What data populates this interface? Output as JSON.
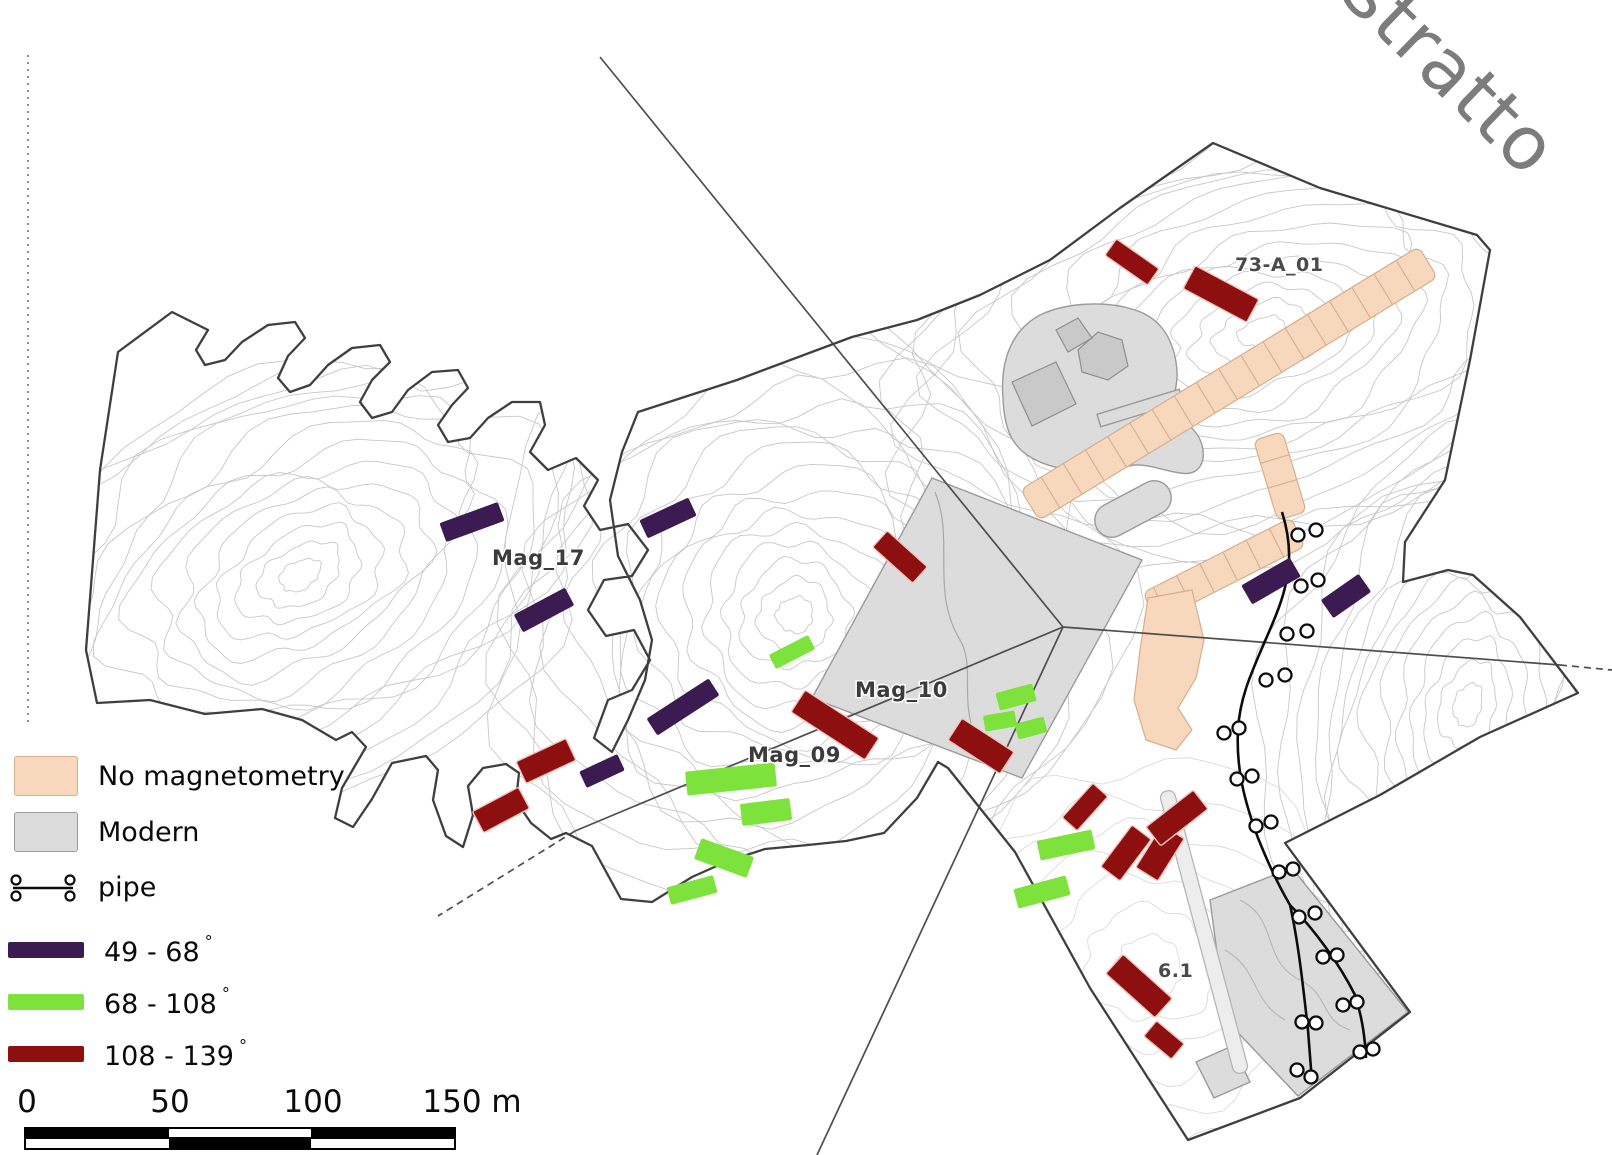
{
  "watermark": {
    "text": "Estratto"
  },
  "legend": {
    "items": [
      {
        "id": "no-magnetometry",
        "label": "No magnetometry",
        "swatch": "peach"
      },
      {
        "id": "modern",
        "label": "Modern",
        "swatch": "gray"
      },
      {
        "id": "pipe",
        "label": "pipe",
        "swatch": "pipe"
      },
      {
        "id": "angle-49-68",
        "label": "49 - 68",
        "degree": "°",
        "swatch": "purple"
      },
      {
        "id": "angle-68-108",
        "label": "68 - 108",
        "degree": "°",
        "swatch": "green"
      },
      {
        "id": "angle-108-139",
        "label": "108 - 139",
        "degree": "°",
        "swatch": "red"
      }
    ]
  },
  "scale_bar": {
    "ticks": [
      "0",
      "50",
      "100",
      "150 m"
    ]
  },
  "map": {
    "labels": [
      {
        "text": "Mag_17",
        "x": 492,
        "y": 565,
        "size": "normal"
      },
      {
        "text": "Mag_10",
        "x": 855,
        "y": 697,
        "size": "normal"
      },
      {
        "text": "Mag_09",
        "x": 748,
        "y": 762,
        "size": "normal"
      },
      {
        "text": "73-A_01",
        "x": 1235,
        "y": 271,
        "size": "small"
      },
      {
        "text": "6.1",
        "x": 1158,
        "y": 977,
        "size": "small"
      }
    ],
    "bars": [
      {
        "type": "p",
        "cx": 472,
        "cy": 522,
        "len": 62,
        "th": 20,
        "angle": -20
      },
      {
        "type": "p",
        "cx": 668,
        "cy": 518,
        "len": 54,
        "th": 20,
        "angle": -25
      },
      {
        "type": "p",
        "cx": 544,
        "cy": 610,
        "len": 58,
        "th": 20,
        "angle": -28
      },
      {
        "type": "p",
        "cx": 683,
        "cy": 707,
        "len": 74,
        "th": 20,
        "angle": -33
      },
      {
        "type": "p",
        "cx": 602,
        "cy": 771,
        "len": 42,
        "th": 18,
        "angle": -25
      },
      {
        "type": "p",
        "cx": 1271,
        "cy": 581,
        "len": 56,
        "th": 22,
        "angle": -30
      },
      {
        "type": "p",
        "cx": 1346,
        "cy": 596,
        "len": 46,
        "th": 22,
        "angle": -35
      },
      {
        "type": "g",
        "cx": 792,
        "cy": 652,
        "len": 44,
        "th": 16,
        "angle": -27
      },
      {
        "type": "g",
        "cx": 731,
        "cy": 779,
        "len": 90,
        "th": 24,
        "angle": -6
      },
      {
        "type": "g",
        "cx": 766,
        "cy": 812,
        "len": 50,
        "th": 22,
        "angle": -7
      },
      {
        "type": "g",
        "cx": 724,
        "cy": 858,
        "len": 56,
        "th": 22,
        "angle": 20
      },
      {
        "type": "g",
        "cx": 692,
        "cy": 890,
        "len": 48,
        "th": 18,
        "angle": -15
      },
      {
        "type": "g",
        "cx": 1066,
        "cy": 845,
        "len": 56,
        "th": 20,
        "angle": -12
      },
      {
        "type": "g",
        "cx": 1042,
        "cy": 892,
        "len": 54,
        "th": 20,
        "angle": -15
      },
      {
        "type": "g",
        "cx": 1016,
        "cy": 697,
        "len": 38,
        "th": 18,
        "angle": -15
      },
      {
        "type": "g",
        "cx": 1000,
        "cy": 721,
        "len": 32,
        "th": 16,
        "angle": -10
      },
      {
        "type": "g",
        "cx": 1031,
        "cy": 728,
        "len": 30,
        "th": 16,
        "angle": -15
      },
      {
        "type": "r",
        "cx": 1132,
        "cy": 262,
        "len": 52,
        "th": 20,
        "angle": 35
      },
      {
        "type": "r",
        "cx": 1221,
        "cy": 294,
        "len": 72,
        "th": 26,
        "angle": 28
      },
      {
        "type": "r",
        "cx": 900,
        "cy": 557,
        "len": 54,
        "th": 22,
        "angle": 42
      },
      {
        "type": "r",
        "cx": 835,
        "cy": 725,
        "len": 88,
        "th": 26,
        "angle": 33
      },
      {
        "type": "r",
        "cx": 981,
        "cy": 746,
        "len": 62,
        "th": 26,
        "angle": 33
      },
      {
        "type": "r",
        "cx": 1085,
        "cy": 807,
        "len": 46,
        "th": 20,
        "angle": -48
      },
      {
        "type": "r",
        "cx": 1126,
        "cy": 853,
        "len": 52,
        "th": 24,
        "angle": -53
      },
      {
        "type": "r",
        "cx": 1160,
        "cy": 853,
        "len": 50,
        "th": 26,
        "angle": -58
      },
      {
        "type": "r",
        "cx": 1177,
        "cy": 818,
        "len": 60,
        "th": 24,
        "angle": -38
      },
      {
        "type": "r",
        "cx": 546,
        "cy": 761,
        "len": 55,
        "th": 24,
        "angle": -25
      },
      {
        "type": "r",
        "cx": 501,
        "cy": 810,
        "len": 52,
        "th": 24,
        "angle": -28
      },
      {
        "type": "r",
        "cx": 1139,
        "cy": 986,
        "len": 66,
        "th": 26,
        "angle": 42
      },
      {
        "type": "r",
        "cx": 1164,
        "cy": 1040,
        "len": 36,
        "th": 20,
        "angle": 40
      }
    ]
  },
  "colors": {
    "peach": "#f7d8bd",
    "peach-stroke": "#d5ae8e",
    "modern": "#dcdcdc",
    "modern-stroke": "#9a9a9a",
    "purple": "#3c1a52",
    "green": "#7de23c",
    "red": "#8e0f10",
    "contour": "#c7c7c7",
    "outline": "#3f3f3f",
    "boundary": "#4e4e4e"
  }
}
